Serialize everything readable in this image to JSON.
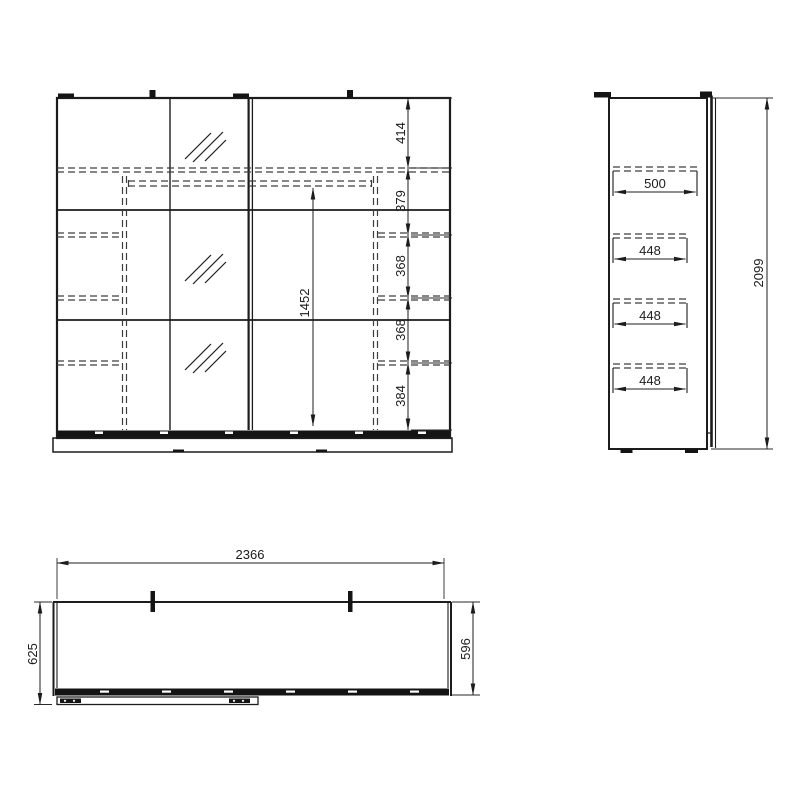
{
  "views": {
    "front": {
      "segment_dims": [
        "414",
        "379",
        "368",
        "368",
        "384"
      ],
      "hanging_space_height": "1452"
    },
    "side": {
      "shelf_widths": [
        "500",
        "448",
        "448",
        "448"
      ],
      "overall_height": "2099"
    },
    "plan": {
      "overall_width": "2366",
      "depth_including_door": "625",
      "carcass_depth": "596"
    }
  },
  "colors": {
    "line": "#1c1c1c",
    "hidden_line": "#3d3d3d",
    "background": "#ffffff"
  }
}
